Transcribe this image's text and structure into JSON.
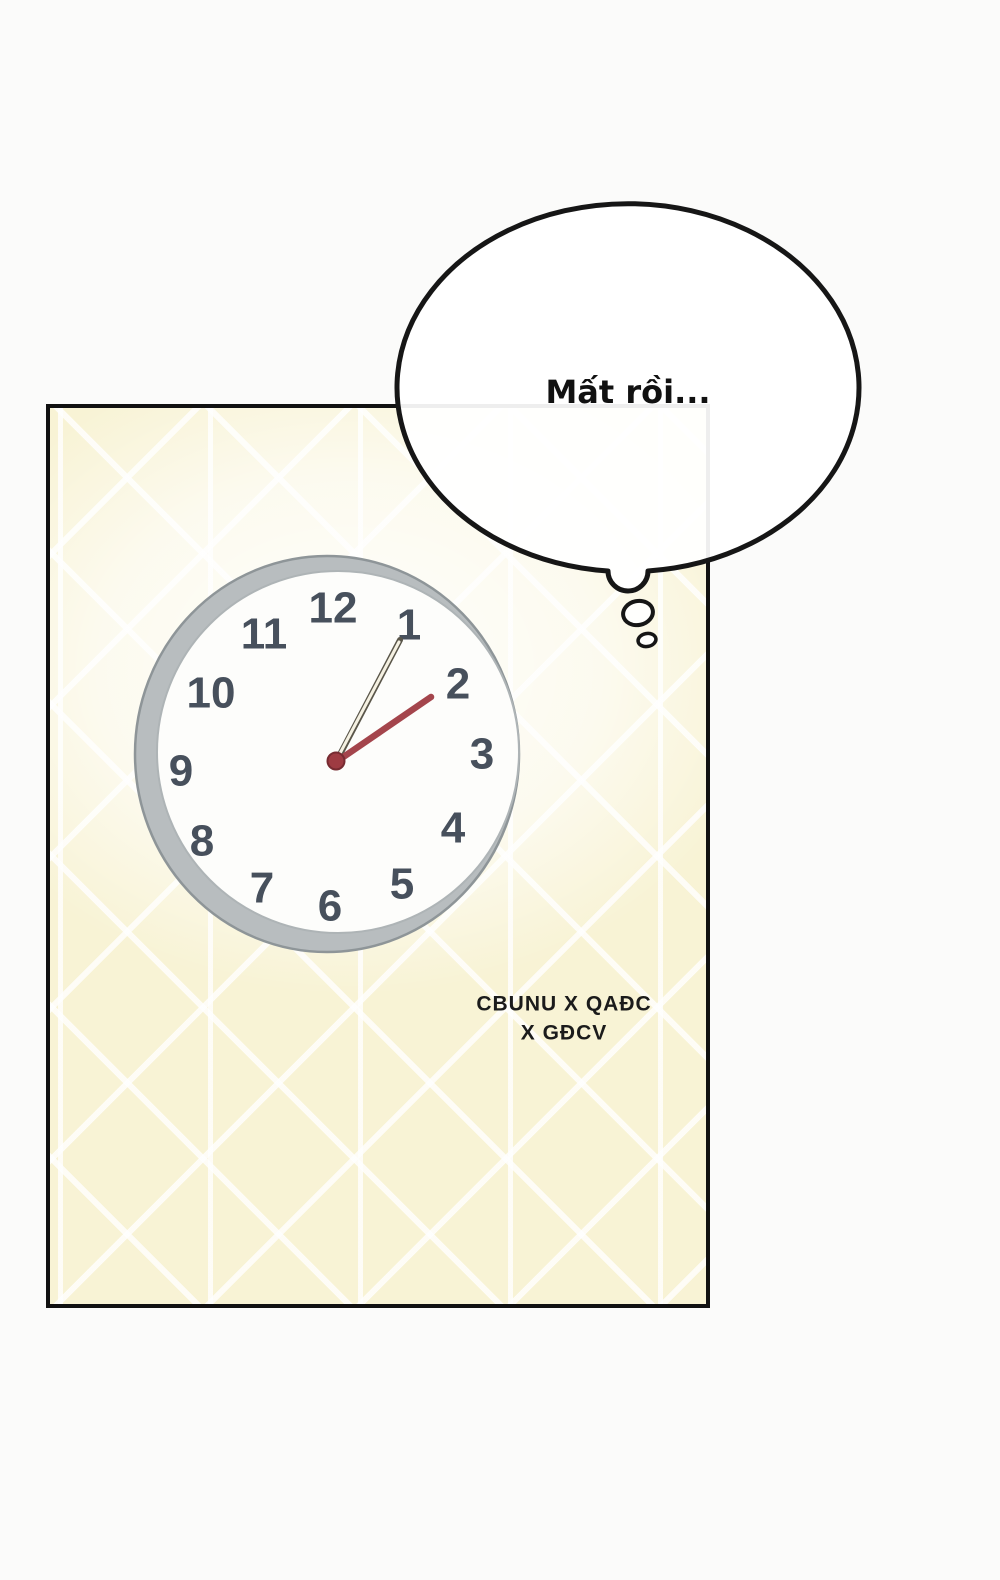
{
  "thought_bubble": {
    "text": "Mất rồi..."
  },
  "clock": {
    "numbers": [
      "12",
      "1",
      "2",
      "3",
      "4",
      "5",
      "6",
      "7",
      "8",
      "9",
      "10",
      "11"
    ],
    "hands": {
      "cream_hand_points_to": "1",
      "red_hand_points_to": "2"
    }
  },
  "credit": {
    "line1": "CBUNU X QAĐC",
    "line2": "X GĐCV"
  },
  "colors": {
    "page_background": "#fbfbfa",
    "panel_background": "#f8f3d5",
    "panel_border": "#111111",
    "clock_rim": "#b8bdbf",
    "clock_rim_edge": "#8e9598",
    "clock_face": "#fdfdfb",
    "clock_face_edge": "#aeb4b6",
    "clock_numbers": "#47505c",
    "cream_hand": "#f5f1e2",
    "cream_hand_outline": "#5a564a",
    "red_hand": "#a4454c",
    "center_cap": "#9e3b42",
    "center_cap_edge": "#772b31",
    "bubble_outline": "#161616"
  }
}
